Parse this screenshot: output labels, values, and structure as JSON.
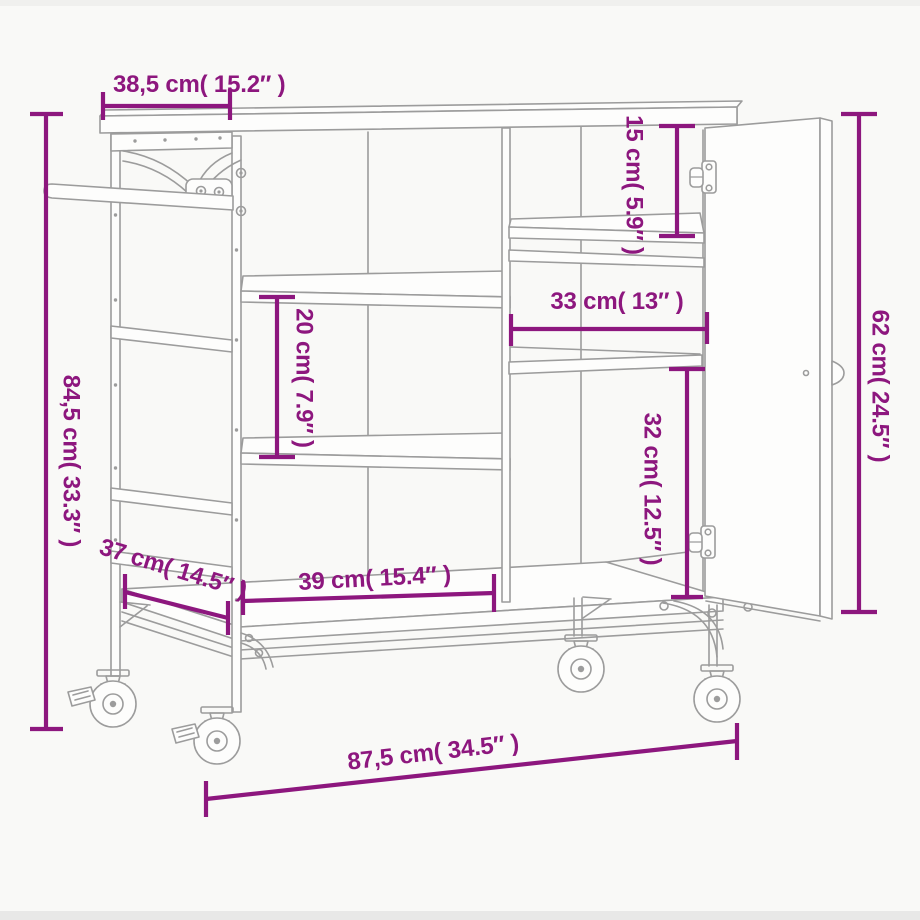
{
  "diagram": {
    "object": "kitchen-trolley-line-drawing",
    "accent_color": "#8d177e",
    "line_color": "#9c9c9c",
    "background_color": "#f9f9f7"
  },
  "dims": {
    "top_depth": "38,5 cm( 15.2″ )",
    "overall_height": "84,5 cm( 33.3″ )",
    "top_shelf_height": "15 cm( 5.9″ )",
    "middle_shelf_width": "33 cm( 13″ )",
    "door_height": "62 cm( 24.5″ )",
    "shelf_spacing": "20 cm( 7.9″ )",
    "cabinet_inner_height": "32 cm( 12.5″ )",
    "depth": "37 cm( 14.5″ )",
    "bottom_shelf_width": "39 cm( 15.4″ )",
    "overall_width": "87,5 cm( 34.5″ )"
  }
}
